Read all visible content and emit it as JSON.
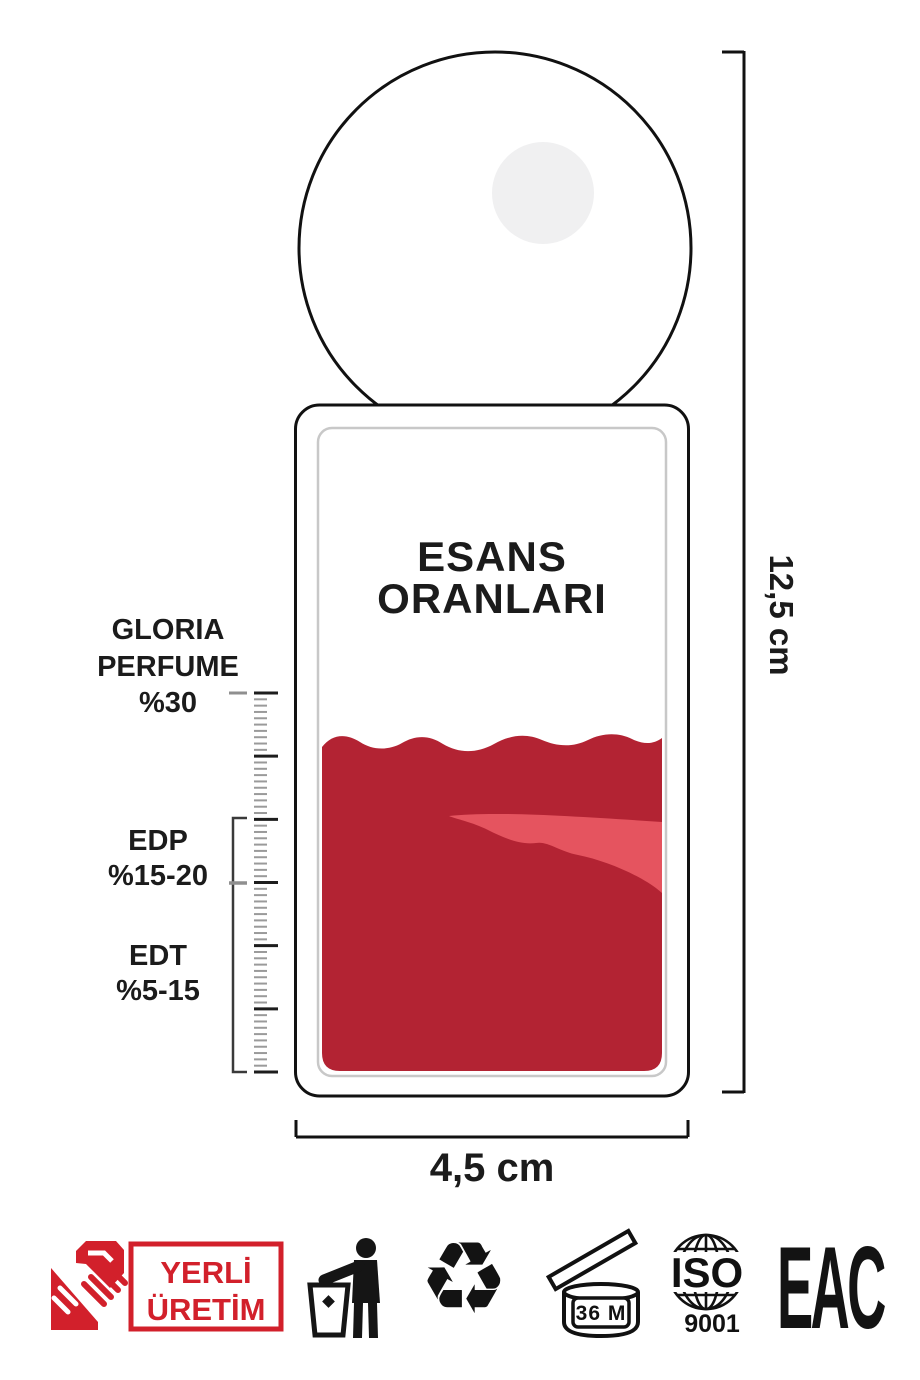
{
  "title": {
    "line1": "ESANS",
    "line2": "ORANLARI"
  },
  "dimensions": {
    "height_label": "12,5 cm",
    "width_label": "4,5 cm"
  },
  "scale": {
    "gloria": {
      "line1": "GLORIA",
      "line2": "PERFUME",
      "line3": "%30"
    },
    "edp": {
      "line1": "EDP",
      "line2": "%15-20"
    },
    "edt": {
      "line1": "EDT",
      "line2": "%5-15"
    },
    "ruler": {
      "major_ticks": 7,
      "minors_per_interval": 9
    }
  },
  "colors": {
    "liquid_dark": "#B32333",
    "liquid_light": "#E5545F",
    "badge_red": "#D2202B",
    "ink": "#151515",
    "inner_border": "#C8C8C8",
    "cap_highlight": "#F0F0F1"
  },
  "footer": {
    "yerli_uretim": {
      "line1": "YERLİ",
      "line2": "ÜRETİM"
    },
    "recycle_glyph": "♻",
    "pao_label": "36 M",
    "iso_label": "ISO",
    "iso_number": "9001",
    "eac_label": "EAC",
    "icons": [
      "handshake-icon",
      "tidyman-icon",
      "recycle-icon",
      "pao-36m-icon",
      "iso-9001-icon",
      "eac-icon"
    ]
  }
}
